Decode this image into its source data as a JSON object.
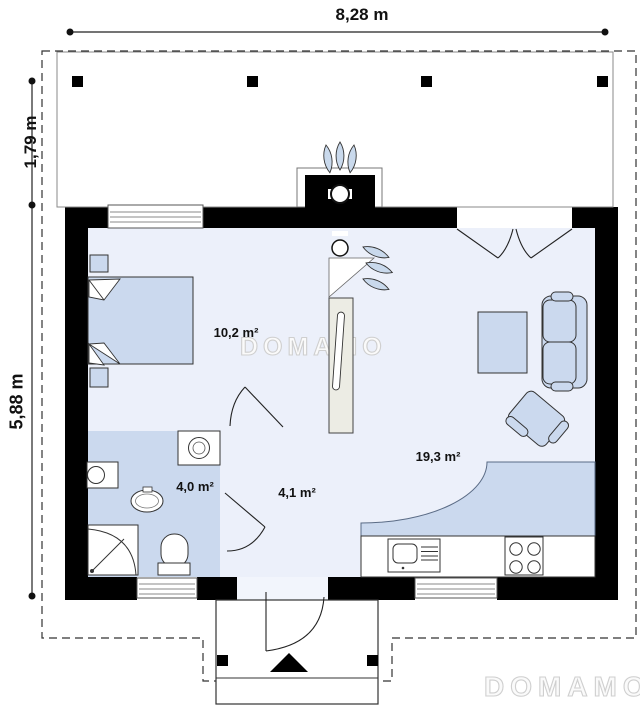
{
  "plan": {
    "dims": {
      "top": "8,28 m",
      "terrace": "1,79 m",
      "house": "5,88 m"
    },
    "rooms": [
      {
        "name": "bedroom",
        "area": "10,2 m²"
      },
      {
        "name": "bathroom",
        "area": "4,0 m²"
      },
      {
        "name": "hall",
        "area": "4,1 m²"
      },
      {
        "name": "living-kitchen",
        "area": "19,3 m²"
      }
    ],
    "watermarks": {
      "center": "DOMAMO",
      "corner": "DOMAMO"
    },
    "colors": {
      "wall": "#000000",
      "floor_light": "#ecf0fa",
      "floor_wet": "#cbd9ee",
      "furniture": "#cbd9ee",
      "flame": "#c9d9ec",
      "terrace": "#ffffff",
      "watermark": "#d4d4d4"
    }
  }
}
